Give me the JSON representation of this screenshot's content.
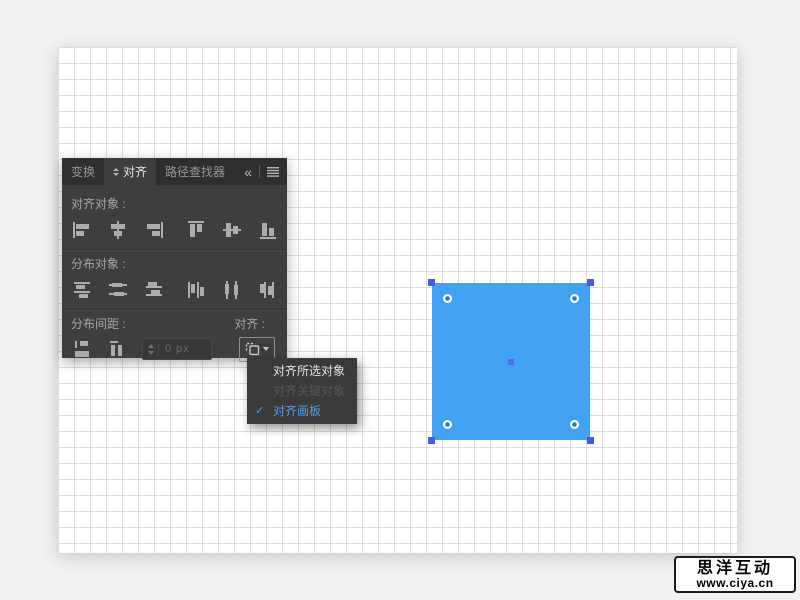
{
  "panel": {
    "tabs": [
      {
        "label": "变换",
        "active": false
      },
      {
        "label": "对齐",
        "active": true
      },
      {
        "label": "路径查找器",
        "active": false
      }
    ],
    "collapse_glyph": "«",
    "align_objects": {
      "label": "对齐对象 :",
      "icons": [
        "horizontal-align-left-icon",
        "horizontal-align-center-icon",
        "horizontal-align-right-icon",
        "vertical-align-top-icon",
        "vertical-align-center-icon",
        "vertical-align-bottom-icon"
      ]
    },
    "distribute_objects": {
      "label": "分布对象 :",
      "icons": [
        "vertical-distribute-top-icon",
        "vertical-distribute-center-icon",
        "vertical-distribute-bottom-icon",
        "horizontal-distribute-left-icon",
        "horizontal-distribute-center-icon",
        "horizontal-distribute-right-icon"
      ]
    },
    "distribute_spacing": {
      "label": "分布间距 :",
      "icons": [
        "vertical-distribute-space-icon",
        "horizontal-distribute-space-icon"
      ],
      "spacing_value": "0 px"
    },
    "align_to": {
      "label": "对齐 :",
      "button_icon": "align-to-artboard-icon"
    }
  },
  "dropdown_menu": {
    "check_glyph": "✓",
    "items": [
      {
        "label": "对齐所选对象",
        "enabled": true,
        "checked": false
      },
      {
        "label": "对齐关键对象",
        "enabled": false,
        "checked": false
      },
      {
        "label": "对齐画板",
        "enabled": true,
        "checked": true
      }
    ]
  },
  "artboard": {
    "object": "selected-blue-square",
    "fill_color": "#41A2F4",
    "selection_handle_color": "#4A5BE0",
    "grid_color": "#dcdcdc"
  },
  "colors": {
    "panel_background": "#3E3E3E",
    "menu_checked_blue": "#4C9FF0",
    "stage_background": "#f2f2f2"
  },
  "watermark": {
    "line1": "思洋互动",
    "line2": "www.ciya.cn"
  }
}
